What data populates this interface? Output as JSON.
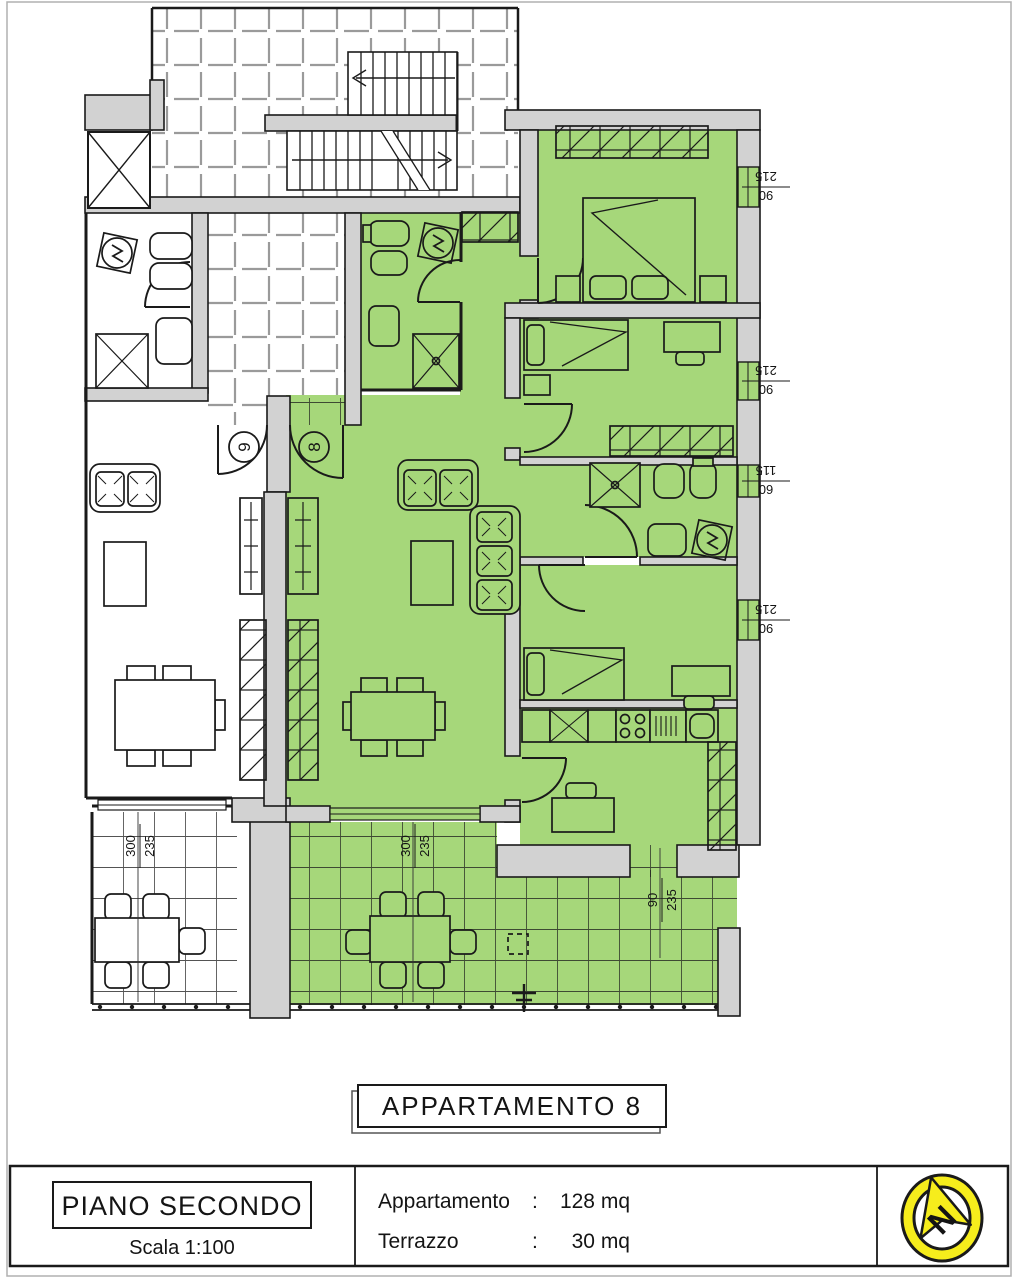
{
  "plan": {
    "title": "APPARTAMENTO 8",
    "door_badges": [
      {
        "number": "9"
      },
      {
        "number": "8"
      }
    ],
    "window_dimensions": [
      {
        "width": "215",
        "height": "90"
      },
      {
        "width": "215",
        "height": "90"
      },
      {
        "width": "115",
        "height": "60"
      },
      {
        "width": "215",
        "height": "90"
      }
    ],
    "terrace_dimensions": [
      {
        "width": "300",
        "height": "235"
      },
      {
        "width": "300",
        "height": "235"
      },
      {
        "width": "90",
        "height": "235"
      }
    ],
    "colors": {
      "apartment_green": "#a6d77a",
      "wall_gray": "#d2d2d2",
      "compass_yellow": "#f6ed1c",
      "line_black": "#1a1a1a"
    }
  },
  "title_block": {
    "floor_label": "PIANO SECONDO",
    "scale_label": "Scala 1:100",
    "areas": [
      {
        "label": "Appartamento",
        "separator": ":",
        "value": "128 mq"
      },
      {
        "label": "Terrazzo",
        "separator": ":",
        "value": "30 mq"
      }
    ],
    "compass_letter": "N"
  }
}
